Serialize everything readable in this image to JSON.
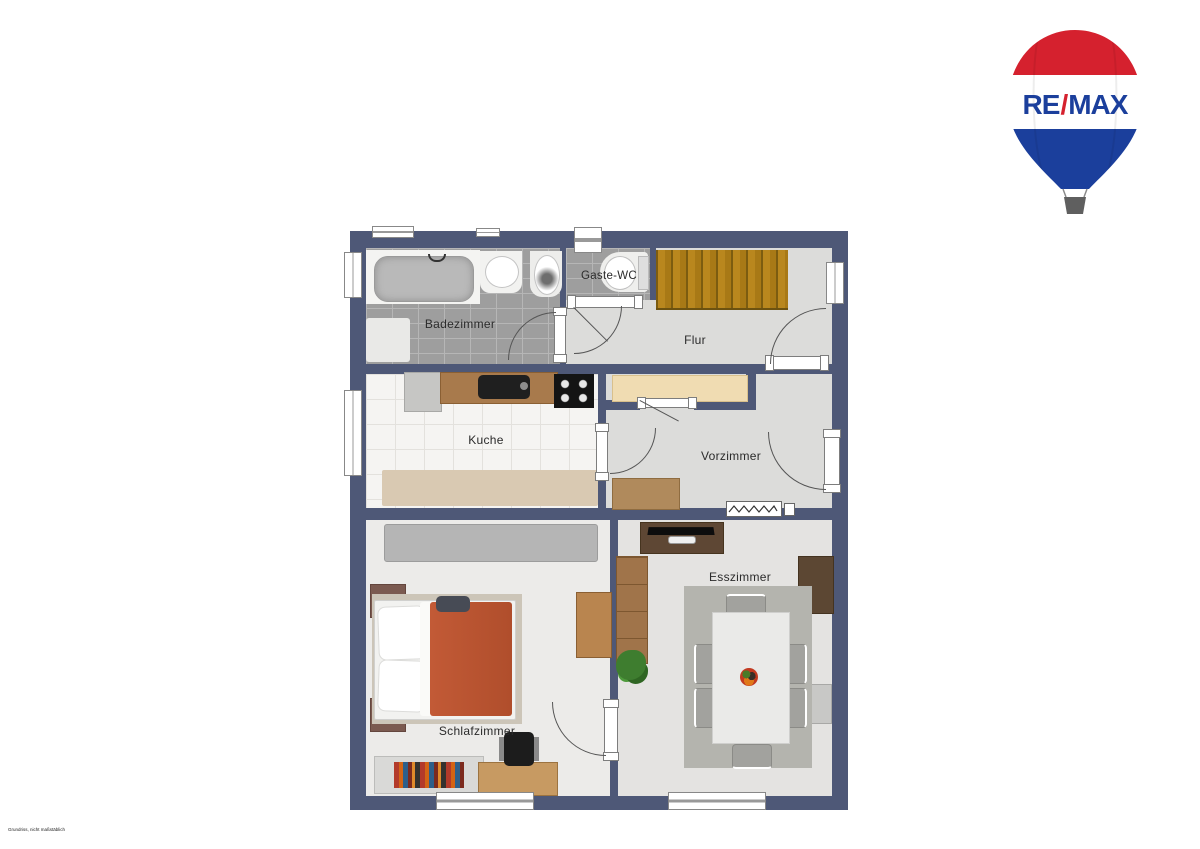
{
  "logo": {
    "re": "RE",
    "slash": "/",
    "max": "MAX",
    "colors": {
      "red": "#d5212e",
      "blue": "#1b3f9c",
      "white": "#ffffff",
      "basket": "#5f5f5f"
    }
  },
  "disclaimer": "Grundriss, nicht maßstäblich",
  "plan": {
    "wall_color": "#4e5877",
    "accent_colors": {
      "stairs_wood": "#b5841c",
      "bed_blanket": "#b65330",
      "closet_cream": "#f0dcb2",
      "kitchen_counter": "#a87a4c"
    },
    "rooms": [
      {
        "id": "badezimmer",
        "label": "Badezimmer"
      },
      {
        "id": "gaeste-wc",
        "label": "Gaste-WC"
      },
      {
        "id": "flur",
        "label": "Flur"
      },
      {
        "id": "kueche",
        "label": "Kuche"
      },
      {
        "id": "vorzimmer",
        "label": "Vorzimmer"
      },
      {
        "id": "schlafzimmer",
        "label": "Schlafzimmer"
      },
      {
        "id": "esszimmer",
        "label": "Esszimmer"
      }
    ]
  }
}
